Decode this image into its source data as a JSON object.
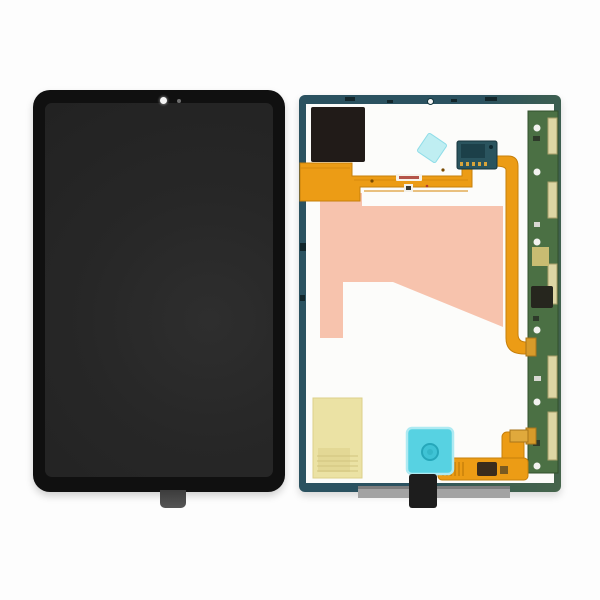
{
  "scene": {
    "description": "Product photo: tablet LCD display assembly replacement part, front glass (left) and internal rear side with flex cables (right)",
    "background": "#fdfdfd"
  },
  "front_panel": {
    "part": "assembled display front, black bezel with camera hole at top and connector tab at bottom",
    "bezel_color": "#101010",
    "screen_color": "#272727",
    "tab_color": "#4e4e4e"
  },
  "back_panel": {
    "part": "rear of display assembly",
    "frame_color": "#2b5260",
    "frame_color_green": "#46654c",
    "interior_color": "#fcfcfa",
    "parts": [
      {
        "name": "black-foam-sticker",
        "color": "#211b18"
      },
      {
        "name": "main-flex-ribbon-cable",
        "color": "#ec9c15"
      },
      {
        "name": "pink-adhesive-film",
        "color": "#f7c3ad"
      },
      {
        "name": "cyan-diamond-sticker",
        "color": "#bfeef2"
      },
      {
        "name": "flex-connector-board",
        "color": "#2a545e"
      },
      {
        "name": "side-pcb-strip",
        "color": "#4b7044"
      },
      {
        "name": "yellow-sticker",
        "color": "#ebe2a4"
      },
      {
        "name": "cyan-square-sticker",
        "color": "#57d2e2"
      },
      {
        "name": "bottom-flex-cable",
        "color": "#ec9c15"
      },
      {
        "name": "black-pull-tab",
        "color": "#1d1d1d"
      },
      {
        "name": "glass-edge-strip",
        "color": "#a3a3a3"
      }
    ]
  },
  "colors": {
    "bg": "#fdfdfd",
    "flex": "#ec9c15",
    "flex_edge": "#c67f0a",
    "pink": "#f7c3ad",
    "black_sticker": "#211b18",
    "connector_teal": "#2a545e",
    "pcb_green": "#4b7044",
    "pcb_border": "#32502c",
    "beige": "#ddd6a4",
    "tan": "#c8bc72",
    "gold": "#d79b2a",
    "yellow": "#ebe2a4",
    "cyan_square": "#57d2e2",
    "cyan_circle": "#3fc3d5",
    "cyan_diamond": "#bfeef2",
    "black_tab": "#1d1d1d",
    "gray_strip": "#a3a3a3",
    "dark_chip": "#26261e",
    "white_dot": "#f2f2ef"
  }
}
